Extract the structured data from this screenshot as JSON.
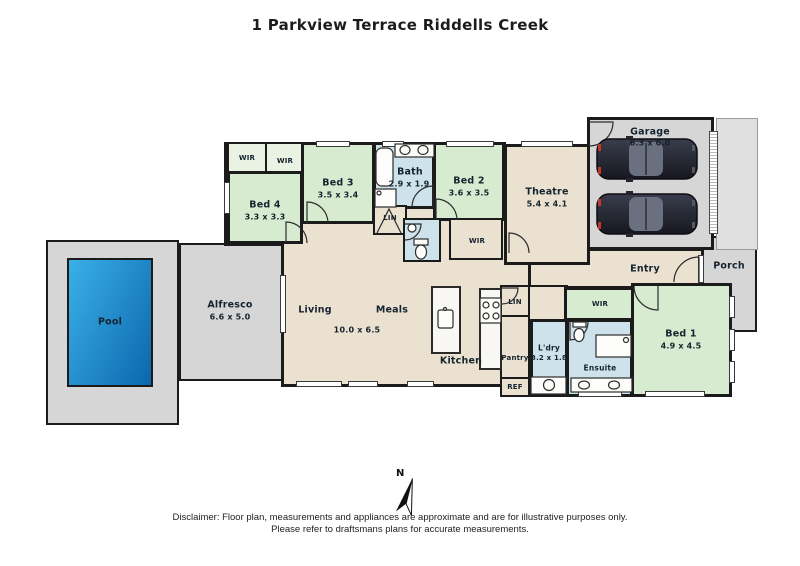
{
  "title": "1 Parkview Terrace Riddells Creek",
  "north_label": "N",
  "disclaimer": {
    "line1": "Disclaimer: Floor plan, measurements and appliances are approximate and are for illustrative purposes only.",
    "line2": "Please refer to draftsmans plans for accurate measurements."
  },
  "palette": {
    "wall": "#1b1b1b",
    "bedroom_green": "#d7ebd1",
    "wet_area_blue": "#cde2ea",
    "interior_beige": "#eae1d0",
    "outdoor_gray": "#d6d6d6",
    "pool_blue": "#1787cf"
  },
  "rooms": {
    "garage": {
      "label": "Garage",
      "dims": "6.3 x 6.0"
    },
    "theatre": {
      "label": "Theatre",
      "dims": "5.4 x 4.1"
    },
    "bed1": {
      "label": "Bed 1",
      "dims": "4.9 x 4.5"
    },
    "bed2": {
      "label": "Bed 2",
      "dims": "3.6 x 3.5"
    },
    "bed3": {
      "label": "Bed 3",
      "dims": "3.5 x 3.4"
    },
    "bed4": {
      "label": "Bed 4",
      "dims": "3.3 x 3.3"
    },
    "bath": {
      "label": "Bath",
      "dims": "2.9 x 1.9"
    },
    "ensuite": {
      "label": "Ensuite"
    },
    "laundry": {
      "label": "L'dry",
      "dims": "3.2 x 1.8"
    },
    "living": {
      "label": "Living"
    },
    "meals": {
      "label": "Meals"
    },
    "living_meals_dims": "10.0 x 6.5",
    "kitchen": {
      "label": "Kitchen"
    },
    "pantry": {
      "label": "Pantry"
    },
    "fridge": {
      "label": "REF"
    },
    "linen_hall": {
      "label": "LIN"
    },
    "linen_kitchen": {
      "label": "LIN"
    },
    "wir_bed4": {
      "label": "WIR"
    },
    "wir_bed3": {
      "label": "WIR"
    },
    "wir_hall": {
      "label": "WIR"
    },
    "wir_bed1": {
      "label": "WIR"
    },
    "entry": {
      "label": "Entry"
    },
    "porch": {
      "label": "Porch"
    },
    "alfresco": {
      "label": "Alfresco",
      "dims": "6.6 x 5.0"
    },
    "pool": {
      "label": "Pool"
    }
  }
}
